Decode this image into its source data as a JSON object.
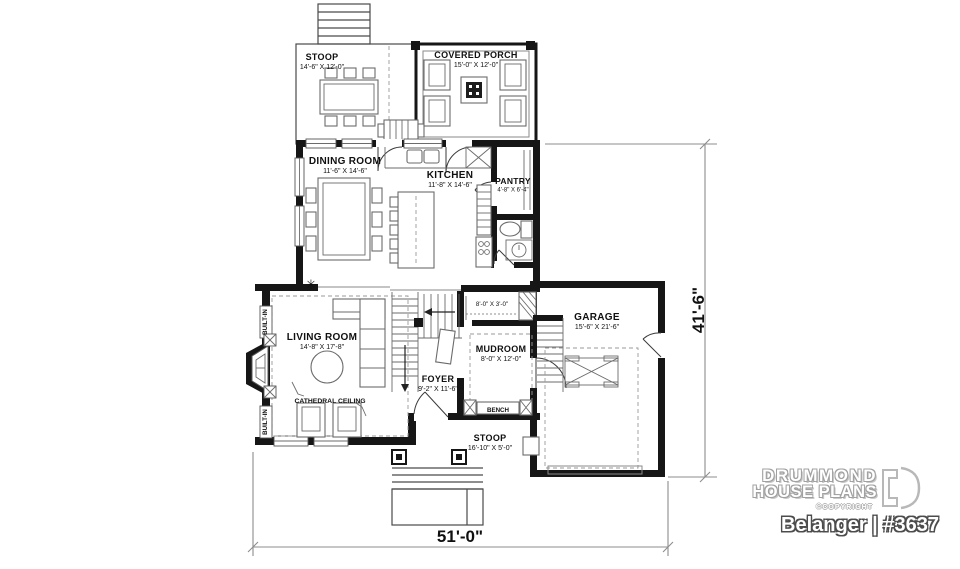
{
  "rooms": {
    "stoopTop": {
      "name": "STOOP",
      "dims": "14'-6\" X 12'-0\""
    },
    "coveredPorch": {
      "name": "COVERED PORCH",
      "dims": "15'-0\" X 12'-0\""
    },
    "dining": {
      "name": "DINING ROOM",
      "dims": "11'-6\" X 14'-6\""
    },
    "kitchen": {
      "name": "KITCHEN",
      "dims": "11'-8\" X 14'-6\""
    },
    "pantry": {
      "name": "PANTRY",
      "dims": "4'-8\" X 6'-4\""
    },
    "living": {
      "name": "LIVING ROOM",
      "dims": "14'-8\" X 17'-8\""
    },
    "foyer": {
      "name": "FOYER",
      "dims": "9'-2\" X 11'-6\""
    },
    "mudroom": {
      "name": "MUDROOM",
      "dims": "8'-0\" X 12'-0\""
    },
    "garage": {
      "name": "GARAGE",
      "dims": "15'-6\" X 21'-6\""
    },
    "stoopBottom": {
      "name": "STOOP",
      "dims": "16'-10\" X 5'-0\""
    }
  },
  "annotations": {
    "cathedralCeiling": "CATHEDRAL CEILING",
    "bench": "BENCH",
    "builtIn": "BUILT-IN",
    "closetDims": "8'-0\" X 3'-0\"",
    "lightSymbol": "✳"
  },
  "dimensions": {
    "width": "51'-0\"",
    "depth": "41'-6\""
  },
  "branding": {
    "line1": "DRUMMOND",
    "line2": "HOUSE PLANS",
    "copyright": "©COPYRIGHT",
    "planTitle": "Belanger | #3637"
  },
  "colors": {
    "wall": "#161616",
    "furniture": "#6b6b6b",
    "dimension": "#8c8c8c",
    "background": "#ffffff"
  }
}
